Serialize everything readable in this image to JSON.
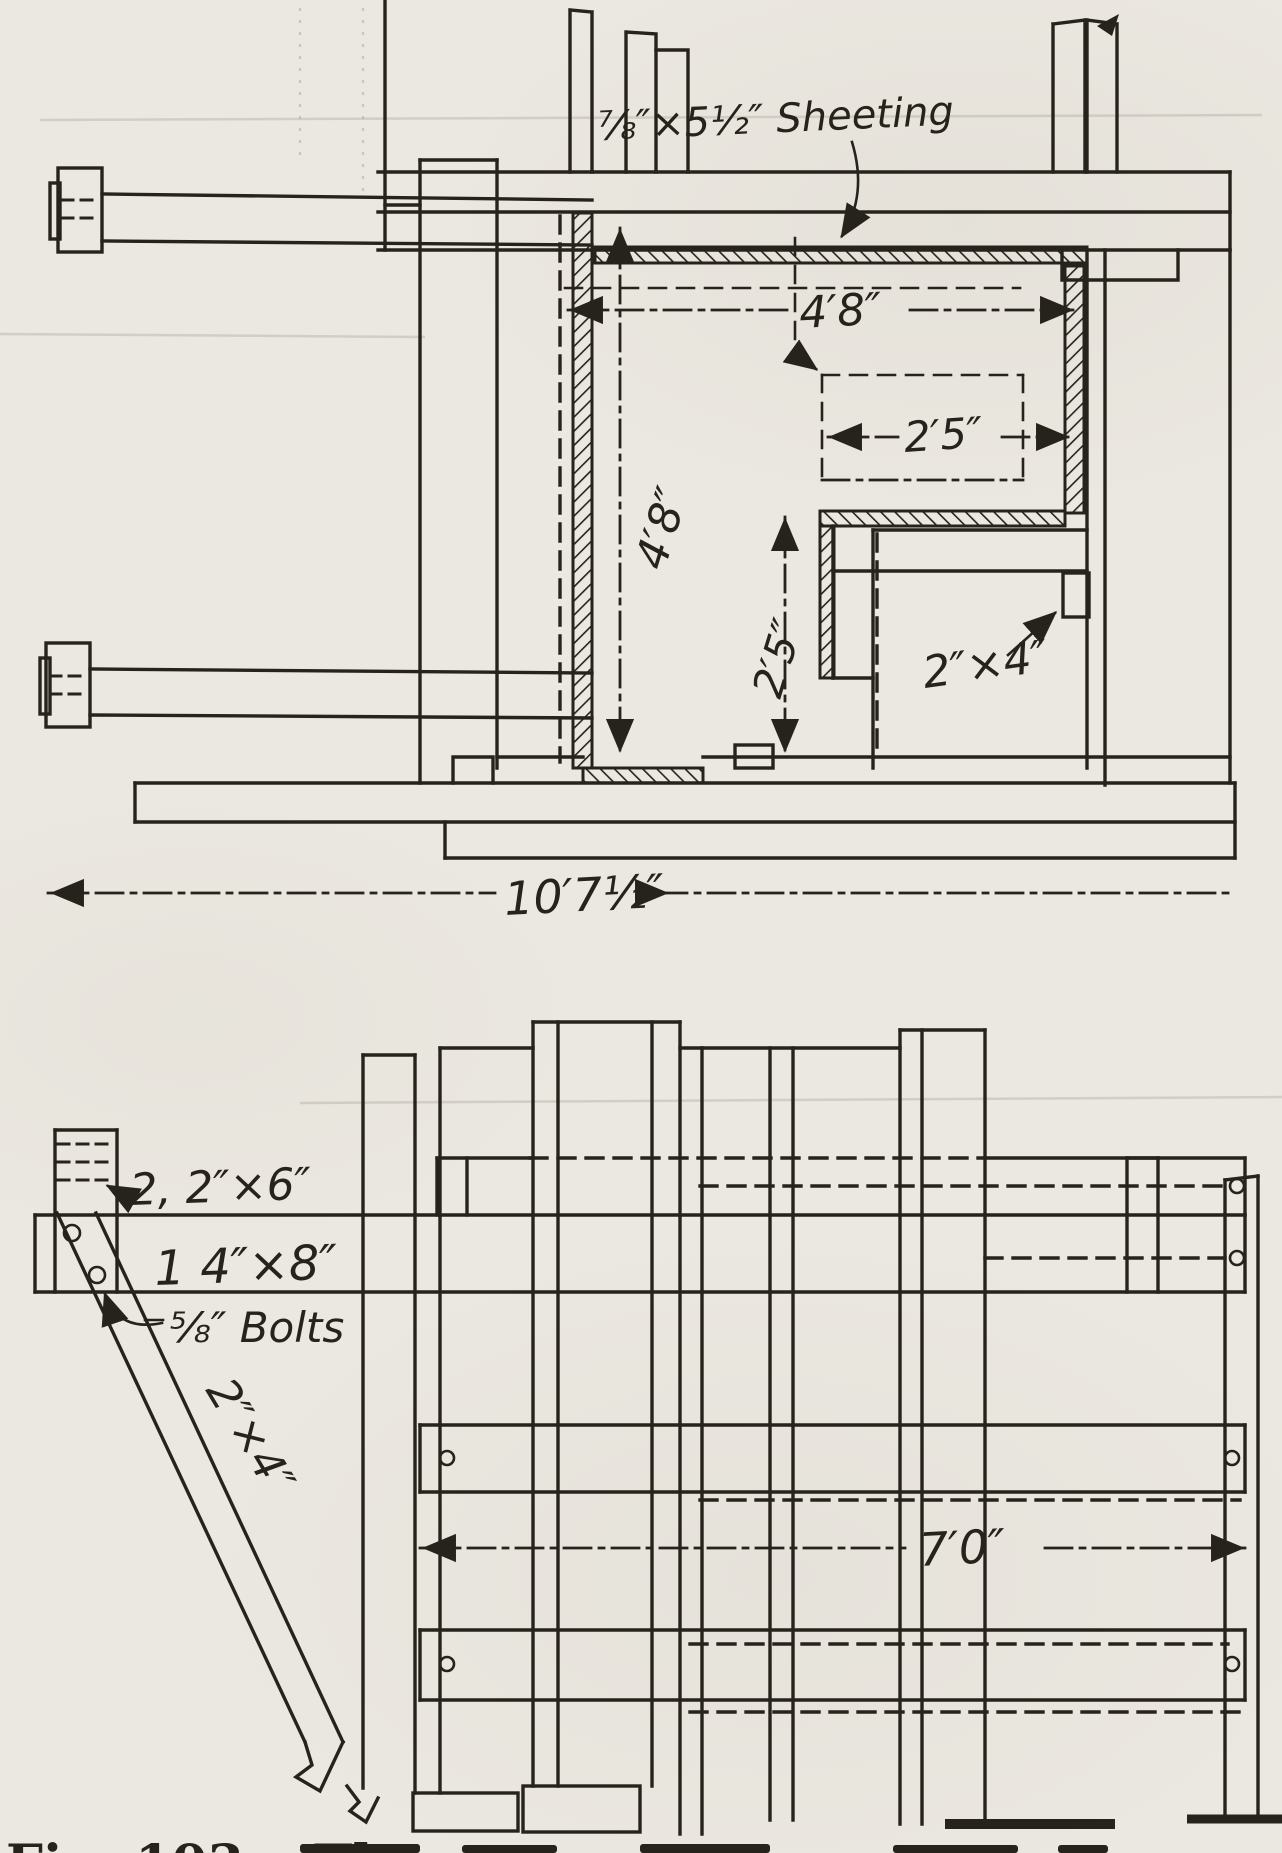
{
  "page": {
    "paper_color": "#ebe8e1",
    "ink_color": "#26231d"
  },
  "plan_view": {
    "sheeting_label": "⅞″×5½″ Sheeting",
    "stud_label": "2″×4″",
    "dim_inner_width": "4′8″",
    "dim_recess_width": "2′5″",
    "dim_inner_height": "4′8″",
    "dim_recess_height": "2′5″",
    "dim_overall_width": "10′7½″"
  },
  "elevation_view": {
    "waler_pair_label": "2, 2″×6″",
    "waler_single_label": "1 4″×8″",
    "bolts_label": "⅝″ Bolts",
    "brace_label": "2″×4″",
    "dim_width": "7′0″"
  },
  "caption": {
    "fragment": "Fig. 103.—Th"
  }
}
